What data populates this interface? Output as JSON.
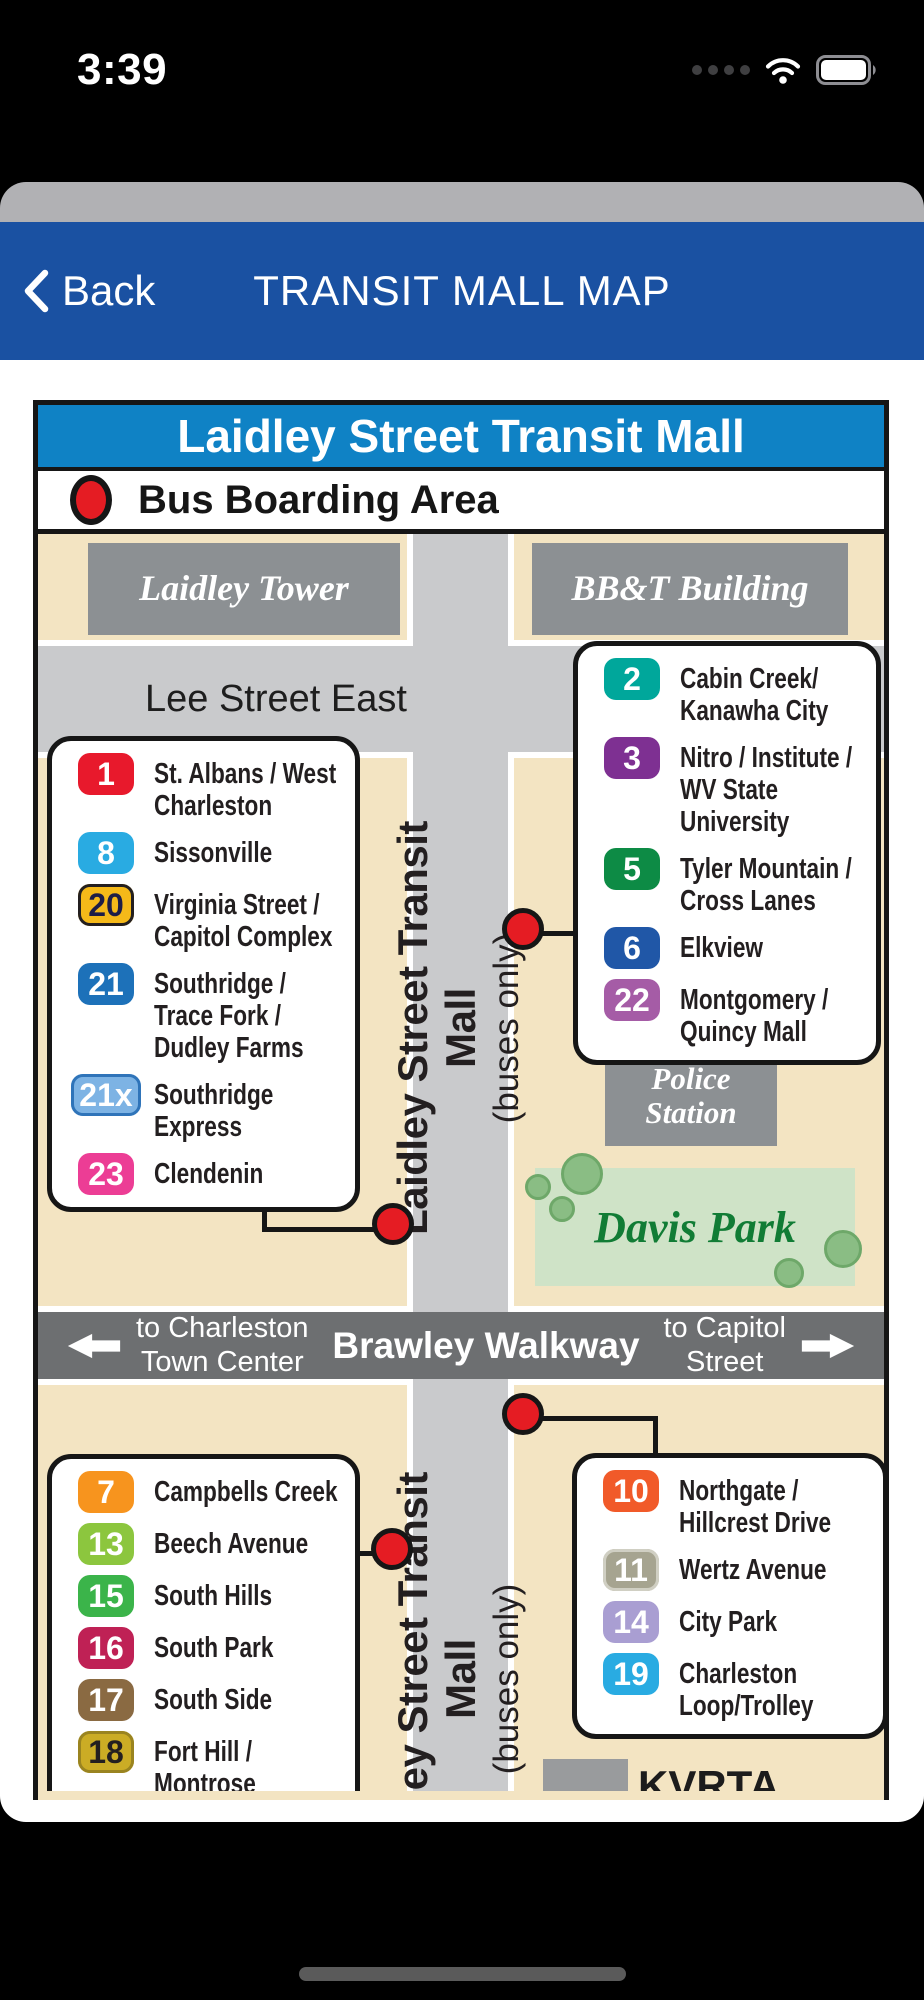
{
  "status_bar": {
    "time": "3:39"
  },
  "nav_bar": {
    "back_label": "Back",
    "title": "TRANSIT MALL MAP"
  },
  "map": {
    "title": "Laidley Street Transit Mall",
    "legend_label": "Bus Boarding Area",
    "buildings": {
      "laidley_tower": "Laidley Tower",
      "bbt_building": "BB&T Building",
      "police_station": "Police\nStation",
      "kvrta": "KVRTA"
    },
    "park": {
      "name": "Davis Park"
    },
    "streets": {
      "lee_street": "Lee Street East",
      "transit_mall_main": "Laidley Street Transit Mall",
      "transit_mall_sub": "(buses only)",
      "brawley": "Brawley Walkway",
      "to_charleston": "to Charleston\nTown Center",
      "to_capitol": "to Capitol\nStreet"
    },
    "route_boxes": {
      "upper_left": [
        {
          "num": "1",
          "bg": "#e8192c",
          "fg": "#ffffff",
          "label": "St. Albans / West\nCharleston"
        },
        {
          "num": "8",
          "bg": "#29abe2",
          "fg": "#ffffff",
          "label": "Sissonville"
        },
        {
          "num": "20",
          "bg": "#f5b919",
          "fg": "#1d1d47",
          "border": "#231f20",
          "label": "Virginia Street /\nCapitol Complex"
        },
        {
          "num": "21",
          "bg": "#1d71b9",
          "fg": "#ffffff",
          "label": "Southridge /\nTrace Fork /\nDudley Farms"
        },
        {
          "num": "21x",
          "bg": "#7db3e4",
          "fg": "#ffffff",
          "border": "#2f74b9",
          "label": "Southridge\nExpress"
        },
        {
          "num": "23",
          "bg": "#ec3d95",
          "fg": "#ffffff",
          "label": "Clendenin"
        }
      ],
      "upper_right": [
        {
          "num": "2",
          "bg": "#00a79b",
          "fg": "#ffffff",
          "label": "Cabin Creek/\nKanawha City"
        },
        {
          "num": "3",
          "bg": "#7e3092",
          "fg": "#ffffff",
          "label": "Nitro / Institute /\nWV State\nUniversity"
        },
        {
          "num": "5",
          "bg": "#0d8b45",
          "fg": "#ffffff",
          "label": "Tyler Mountain /\nCross Lanes"
        },
        {
          "num": "6",
          "bg": "#2057a7",
          "fg": "#ffffff",
          "label": "Elkview"
        },
        {
          "num": "22",
          "bg": "#a55ca6",
          "fg": "#ffffff",
          "label": "Montgomery /\nQuincy Mall"
        }
      ],
      "lower_left": [
        {
          "num": "7",
          "bg": "#f7941e",
          "fg": "#ffffff",
          "label": "Campbells Creek"
        },
        {
          "num": "13",
          "bg": "#8cc63e",
          "fg": "#ffffff",
          "label": "Beech Avenue"
        },
        {
          "num": "15",
          "bg": "#3bb44a",
          "fg": "#ffffff",
          "label": "South Hills"
        },
        {
          "num": "16",
          "bg": "#bf2155",
          "fg": "#ffffff",
          "label": "South Park"
        },
        {
          "num": "17",
          "bg": "#8a6a42",
          "fg": "#ffffff",
          "label": "South Side"
        },
        {
          "num": "18",
          "bg": "#cbac25",
          "fg": "#231f20",
          "border": "#9a8420",
          "label": "Fort Hill /\nMontrose"
        }
      ],
      "lower_right": [
        {
          "num": "10",
          "bg": "#f15a29",
          "fg": "#ffffff",
          "label": "Northgate /\nHillcrest Drive"
        },
        {
          "num": "11",
          "bg": "#a6a490",
          "fg": "#ffffff",
          "border": "#d0cfc3",
          "label": "Wertz Avenue"
        },
        {
          "num": "14",
          "bg": "#a99ed2",
          "fg": "#ffffff",
          "label": "City Park"
        },
        {
          "num": "19",
          "bg": "#29abe2",
          "fg": "#ffffff",
          "label": "Charleston\nLoop/Trolley"
        }
      ]
    },
    "colors": {
      "nav_blue": "#1a51a2",
      "header_blue": "#0f82c5",
      "stop_red": "#e51c23",
      "tan": "#f3e4c2",
      "street_gray": "#c9cacc",
      "building_gray": "#8c9093",
      "walkway_gray": "#6d6f71",
      "park_bg": "#cfe3c7",
      "park_text": "#117c35",
      "tree_fill": "#8abd84",
      "tree_edge": "#6ea869"
    }
  }
}
